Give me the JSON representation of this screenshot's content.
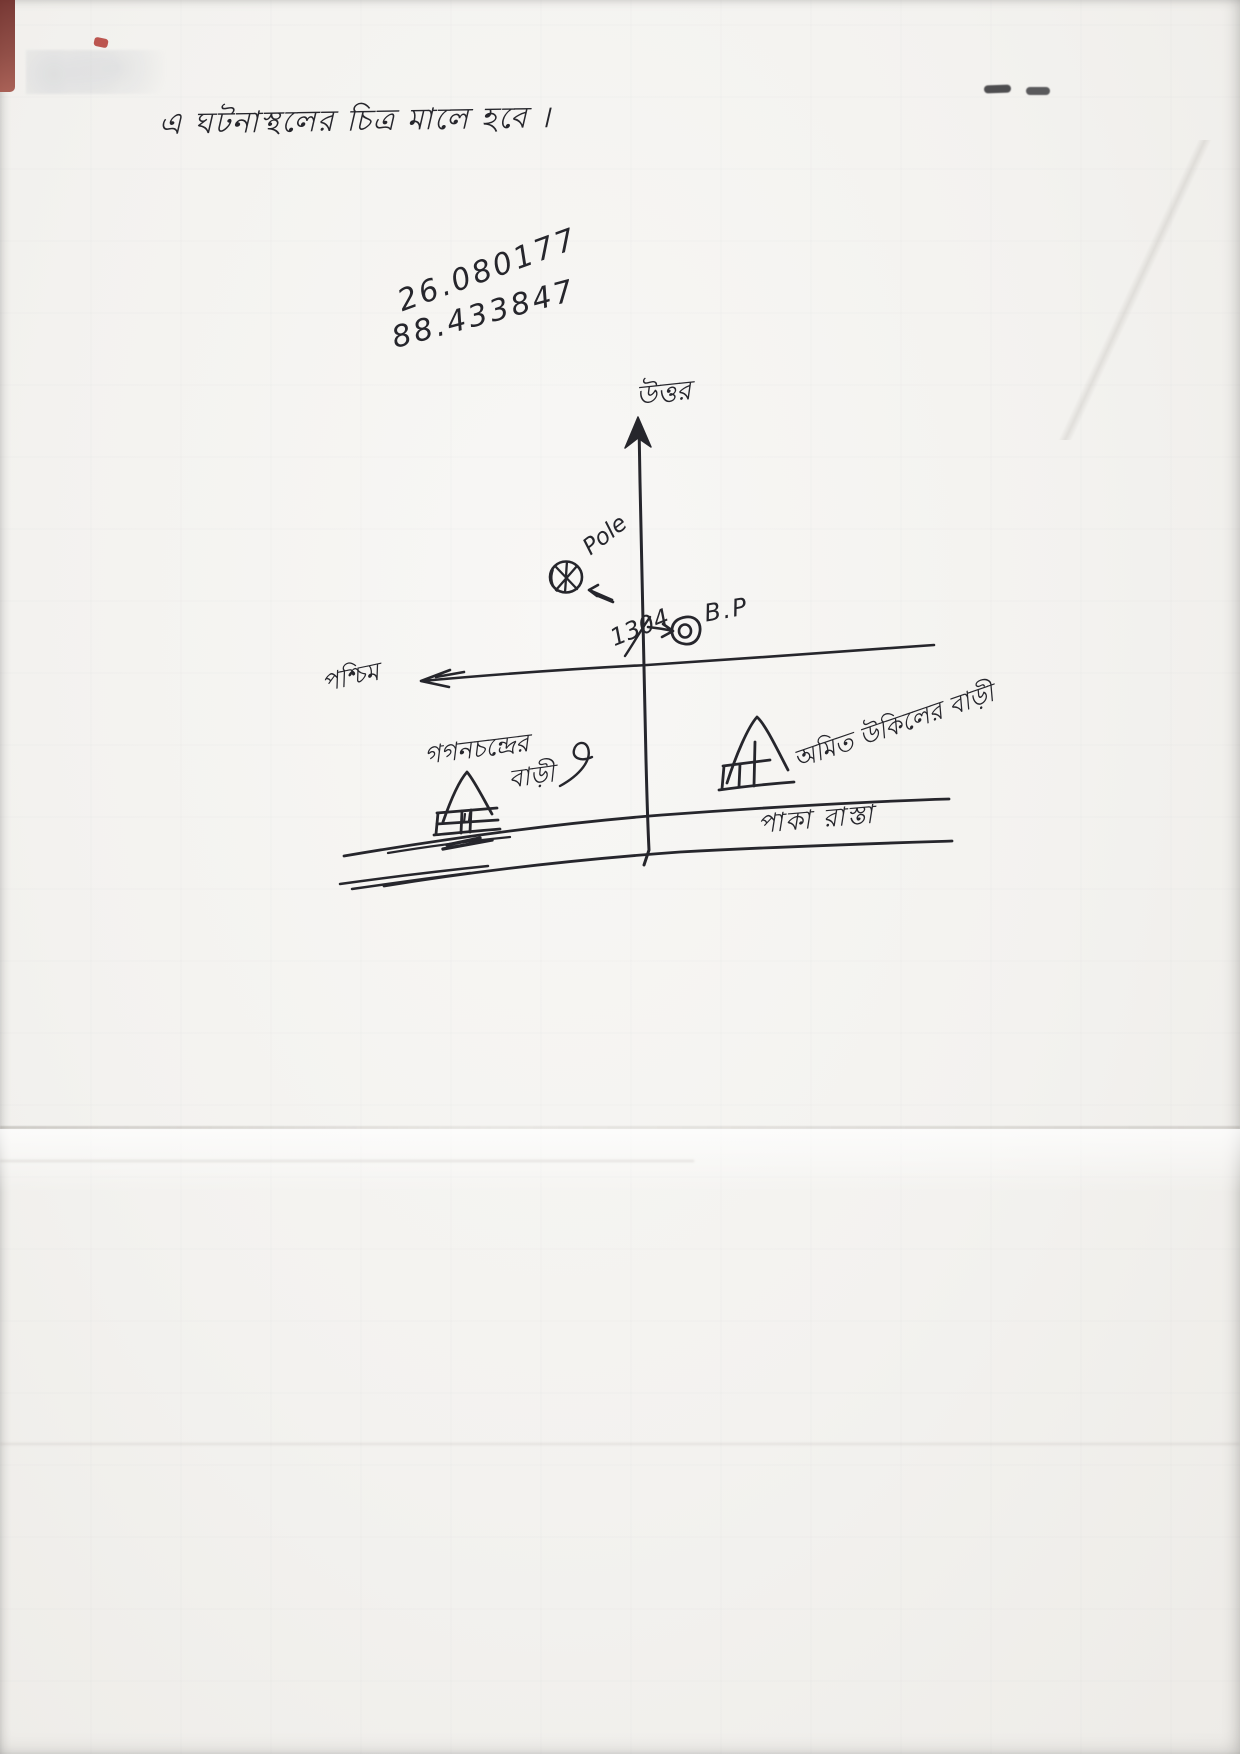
{
  "sketch": {
    "title": "এ ঘটনাস্থলের চিত্র মালে হবে ।",
    "coordinates": {
      "latitude": "26.080177",
      "longitude": "88.433847"
    },
    "compass": {
      "north": "উত্তর",
      "west": "পশ্চিম"
    },
    "markers": {
      "pole": "Pole",
      "boundary_pillar": "B.P",
      "plot_number": "1304"
    },
    "labels": {
      "right_house": "অমিত উকিলের বাড়ী",
      "left_house_line1": "গগনচন্দ্রের",
      "left_house_line2": "বাড়ী",
      "road": "পাকা রাস্তা"
    },
    "colors": {
      "ink": "#26262c",
      "paper": "#f3f2ef"
    }
  }
}
